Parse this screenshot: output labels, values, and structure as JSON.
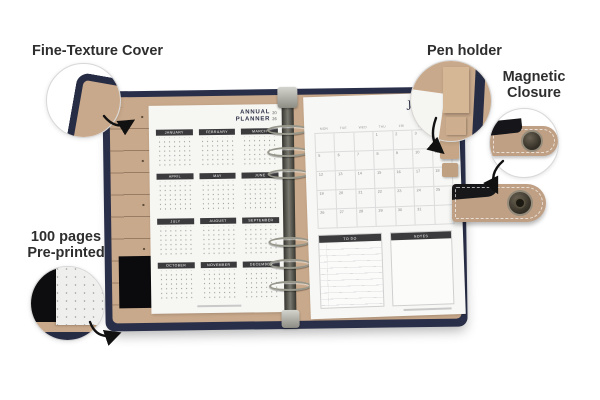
{
  "annotations": {
    "fine_texture": "Fine-Texture Cover",
    "pen_holder": "Pen holder",
    "magnetic_1": "Magnetic",
    "magnetic_2": "Closure",
    "pages_1": "100 pages",
    "pages_2": "Pre-printed"
  },
  "left_page": {
    "title_1": "ANNUAL",
    "title_2": "PLANNER",
    "year_1": "20",
    "year_2": "26",
    "months": [
      "JANUARY",
      "FEBRUARY",
      "MARCH",
      "APRIL",
      "MAY",
      "JUNE",
      "JULY",
      "AUGUST",
      "SEPTEMBER",
      "OCTOBER",
      "NOVEMBER",
      "DECEMBER"
    ]
  },
  "right_page": {
    "month": "JAN",
    "year_1": "20",
    "year_2": "26",
    "day_headers": [
      "MON",
      "TUE",
      "WED",
      "THU",
      "FRI",
      "SAT",
      "SUN"
    ],
    "weeks": [
      [
        "",
        "",
        "",
        "1",
        "2",
        "3",
        "4"
      ],
      [
        "5",
        "6",
        "7",
        "8",
        "9",
        "10",
        "11"
      ],
      [
        "12",
        "13",
        "14",
        "15",
        "16",
        "17",
        "18"
      ],
      [
        "19",
        "20",
        "21",
        "22",
        "23",
        "24",
        "25"
      ],
      [
        "26",
        "27",
        "28",
        "29",
        "30",
        "31",
        ""
      ]
    ],
    "todo_label": "TO DO",
    "notes_label": "NOTES"
  },
  "colors": {
    "cover_navy": "#2a2f49",
    "lining_tan": "#c9a98b",
    "page_white": "#f6f6f3",
    "header_bar": "#3b3b3d",
    "strap_tan": "#bfa084",
    "background": "#ffffff"
  }
}
